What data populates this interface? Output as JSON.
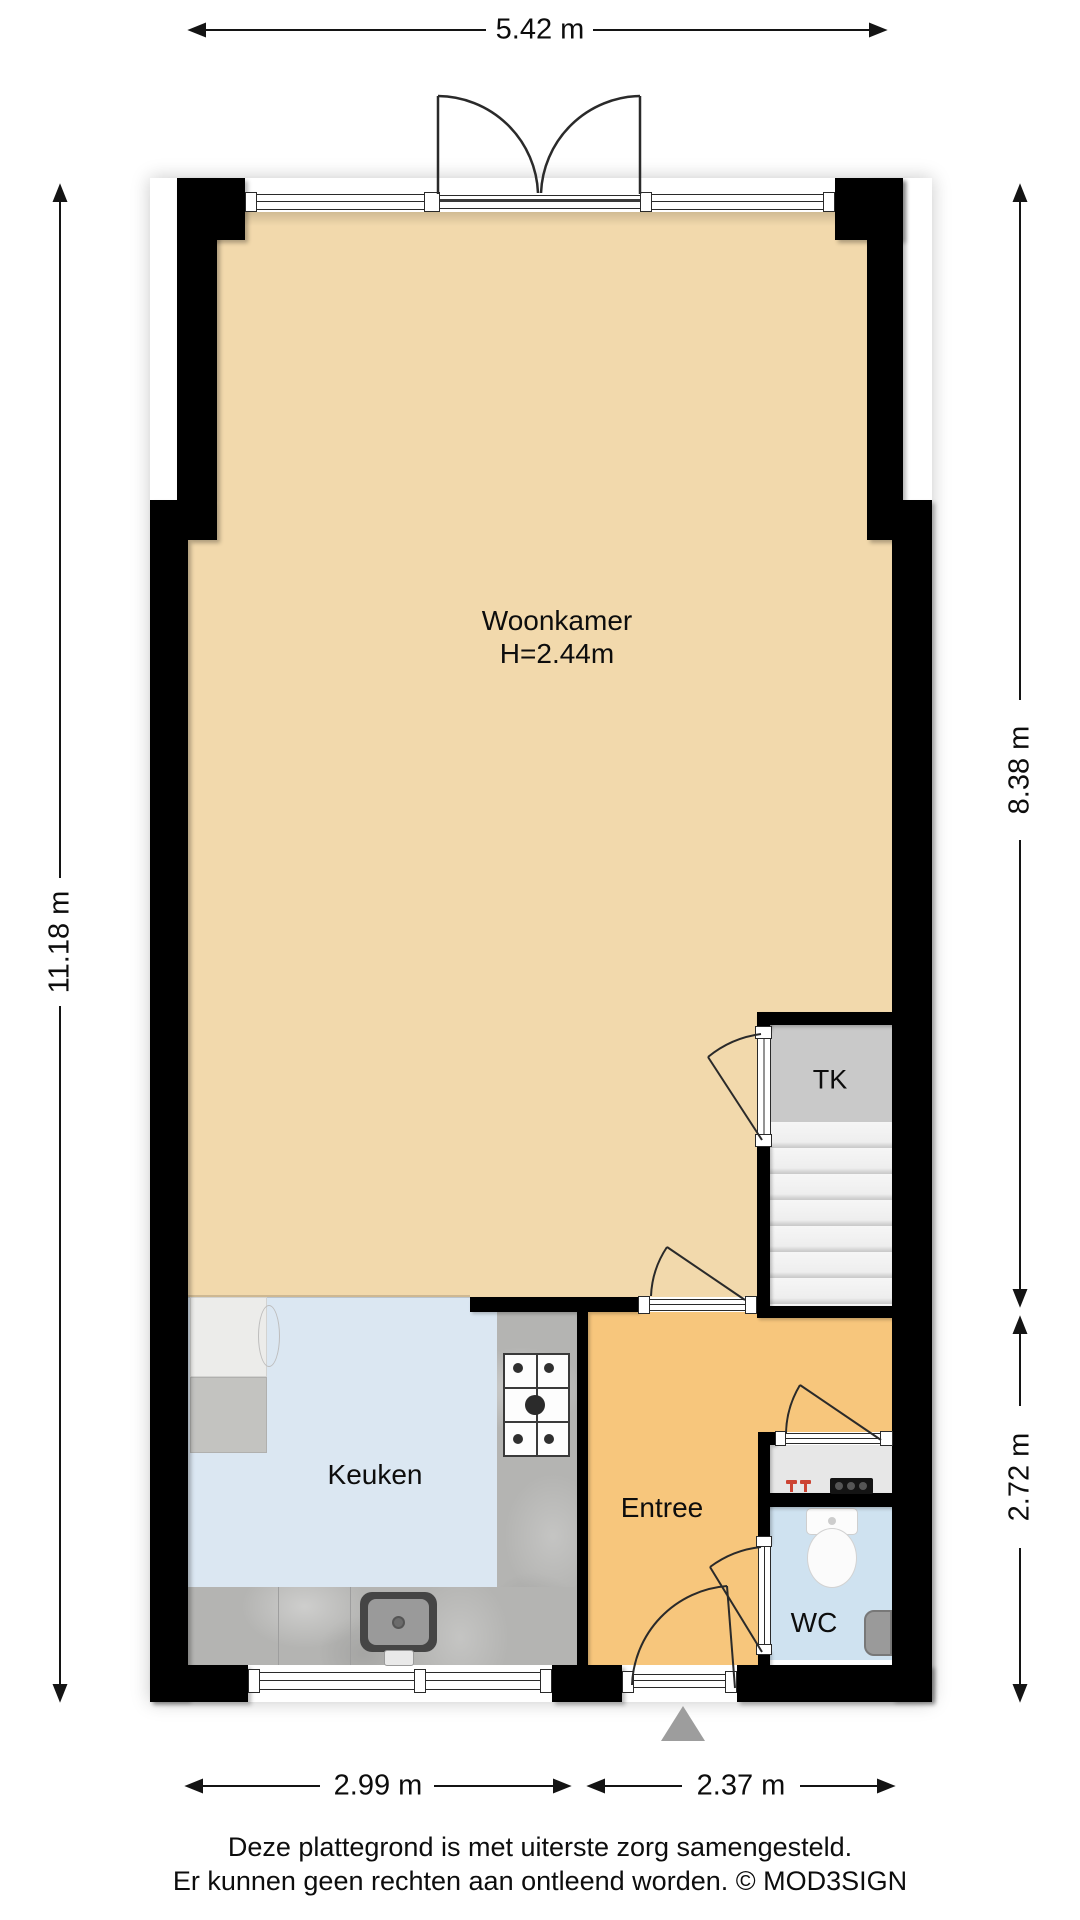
{
  "meta": {
    "type": "floorplan",
    "language": "nl"
  },
  "rooms": {
    "woonkamer": {
      "label": "Woonkamer",
      "height": "H=2.44m"
    },
    "keuken": {
      "label": "Keuken"
    },
    "entree": {
      "label": "Entree"
    },
    "wc": {
      "label": "WC"
    },
    "tk": {
      "label": "TK"
    }
  },
  "dimensions": {
    "top": "5.42 m",
    "left": "11.18 m",
    "right_upper": "8.38 m",
    "right_lower": "2.72 m",
    "bottom_left": "2.99 m",
    "bottom_right": "2.37 m"
  },
  "footer": {
    "line1": "Deze plattegrond is met uiterste zorg samengesteld.",
    "line2": "Er kunnen geen rechten aan ontleend worden. © MOD3SIGN"
  },
  "colors": {
    "wall": "#000000",
    "woonkamer_floor": "#f2d9ac",
    "keuken_floor": "#dbe7f2",
    "entree_floor": "#f7c67c",
    "wc_floor": "#cfe2f0",
    "tk_floor": "#c9c9c9",
    "stairs": "#f1f1f1",
    "counter": "#b4b4b2",
    "triangle": "#9d9d9d",
    "tap_icon": "#cc4433"
  }
}
